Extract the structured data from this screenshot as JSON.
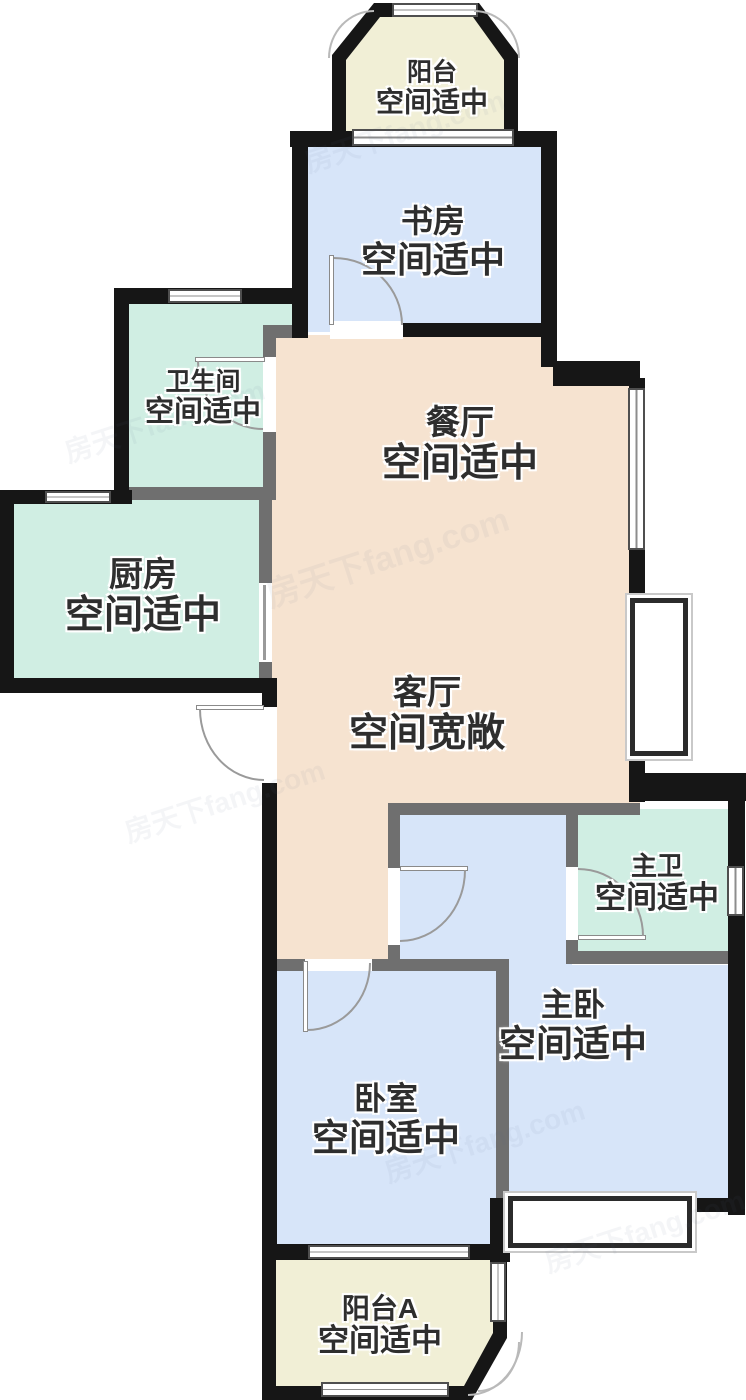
{
  "watermark": "房天下fang.com",
  "colors": {
    "cream": "#f1efd6",
    "blue": "#d7e5f9",
    "teal": "#d0eee3",
    "peach": "#f6e3d0",
    "wall_exterior": "#161616",
    "wall_interior": "#6f6f6f",
    "label_text": "#2e2e2e"
  },
  "rooms": [
    {
      "id": "balcony-top",
      "name": "阳台",
      "desc": "空间适中"
    },
    {
      "id": "study",
      "name": "书房",
      "desc": "空间适中"
    },
    {
      "id": "bathroom",
      "name": "卫生间",
      "desc": "空间适中"
    },
    {
      "id": "dining",
      "name": "餐厅",
      "desc": "空间适中"
    },
    {
      "id": "kitchen",
      "name": "厨房",
      "desc": "空间适中"
    },
    {
      "id": "living",
      "name": "客厅",
      "desc": "空间宽敞"
    },
    {
      "id": "master-bath",
      "name": "主卫",
      "desc": "空间适中"
    },
    {
      "id": "master-bedroom",
      "name": "主卧",
      "desc": "空间适中"
    },
    {
      "id": "bedroom",
      "name": "卧室",
      "desc": "空间适中"
    },
    {
      "id": "balcony-a",
      "name": "阳台A",
      "desc": "空间适中"
    }
  ]
}
